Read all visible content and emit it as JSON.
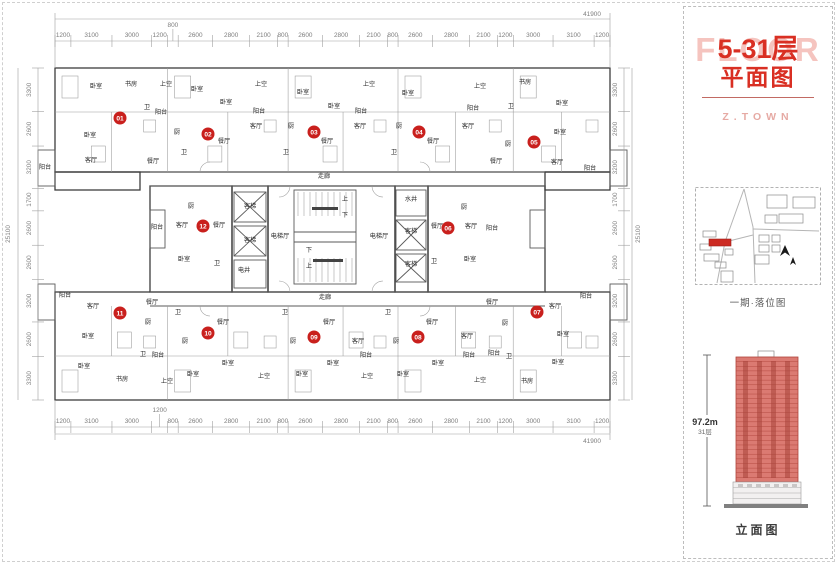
{
  "panel": {
    "watermark": "FLOOR",
    "title_line1": "5-31层",
    "title_line2": "平面图",
    "brand": "Z.TOWN",
    "site_map_caption": "一期·落位图",
    "elevation": {
      "height": "97.2m",
      "floors": "31层",
      "caption": "立面图",
      "floor_count": 31
    }
  },
  "colors": {
    "accent_red": "#d92f23",
    "badge_red": "#c9201d",
    "building_red": "#db7a72",
    "building_line": "#b0453c",
    "watermark_pink": "#f5c4bf",
    "brand_pink": "#e6aaa4"
  },
  "dimensions": {
    "top": {
      "total": "41900",
      "segments": [
        1200,
        3100,
        3000,
        1200,
        800,
        2600,
        2800,
        2100,
        800,
        2600,
        2800,
        2100,
        800,
        2600,
        2800,
        2100,
        1200,
        3000,
        3100,
        1200
      ],
      "raised_index": 4
    },
    "bottom": {
      "total": "41900",
      "segments": [
        1200,
        3100,
        3000,
        1200,
        800,
        2600,
        2800,
        2100,
        800,
        2600,
        2800,
        2100,
        800,
        2600,
        2800,
        2100,
        1200,
        3000,
        3100,
        1200
      ],
      "raised_index": 3
    },
    "left": {
      "total": "25100",
      "segments": [
        3300,
        2600,
        3200,
        1700,
        2600,
        2600,
        3200,
        2600,
        3300
      ]
    },
    "right": {
      "total": "25100",
      "segments": [
        3300,
        2600,
        3200,
        1700,
        2600,
        2600,
        3200,
        2600,
        3300
      ]
    }
  },
  "units": [
    [
      120,
      118,
      "01"
    ],
    [
      208,
      134,
      "02"
    ],
    [
      314,
      132,
      "03"
    ],
    [
      419,
      132,
      "04"
    ],
    [
      534,
      142,
      "05"
    ],
    [
      448,
      228,
      "06"
    ],
    [
      537,
      312,
      "07"
    ],
    [
      418,
      337,
      "08"
    ],
    [
      314,
      337,
      "09"
    ],
    [
      208,
      333,
      "10"
    ],
    [
      120,
      313,
      "11"
    ],
    [
      203,
      226,
      "12"
    ]
  ],
  "room_labels": [
    [
      96,
      88,
      "卧室"
    ],
    [
      131,
      86,
      "书房"
    ],
    [
      166,
      86,
      "上空"
    ],
    [
      197,
      91,
      "卧室"
    ],
    [
      226,
      104,
      "卧室"
    ],
    [
      161,
      114,
      "阳台"
    ],
    [
      147,
      109,
      "卫"
    ],
    [
      90,
      137,
      "卧室"
    ],
    [
      177,
      134,
      "厨"
    ],
    [
      91,
      162,
      "客厅"
    ],
    [
      45,
      169,
      "阳台"
    ],
    [
      153,
      163,
      "餐厅"
    ],
    [
      224,
      143,
      "餐厅"
    ],
    [
      184,
      154,
      "卫"
    ],
    [
      261,
      86,
      "上空"
    ],
    [
      303,
      94,
      "卧室"
    ],
    [
      334,
      108,
      "卧室"
    ],
    [
      259,
      113,
      "阳台"
    ],
    [
      256,
      128,
      "客厅"
    ],
    [
      291,
      128,
      "厨"
    ],
    [
      327,
      143,
      "餐厅"
    ],
    [
      286,
      154,
      "卫"
    ],
    [
      369,
      86,
      "上空"
    ],
    [
      408,
      95,
      "卧室"
    ],
    [
      361,
      113,
      "阳台"
    ],
    [
      360,
      128,
      "客厅"
    ],
    [
      399,
      128,
      "厨"
    ],
    [
      394,
      154,
      "卫"
    ],
    [
      433,
      143,
      "餐厅"
    ],
    [
      480,
      88,
      "上空"
    ],
    [
      525,
      84,
      "书房"
    ],
    [
      562,
      105,
      "卧室"
    ],
    [
      473,
      110,
      "阳台"
    ],
    [
      511,
      108,
      "卫"
    ],
    [
      468,
      128,
      "客厅"
    ],
    [
      508,
      146,
      "厨"
    ],
    [
      496,
      163,
      "餐厅"
    ],
    [
      560,
      134,
      "卧室"
    ],
    [
      557,
      164,
      "客厅"
    ],
    [
      590,
      170,
      "阳台"
    ],
    [
      324,
      178,
      "走廊"
    ],
    [
      325,
      299,
      "走廊"
    ],
    [
      250,
      208,
      "客梯"
    ],
    [
      250,
      242,
      "客梯"
    ],
    [
      244,
      272,
      "电井"
    ],
    [
      280,
      238,
      "电梯厅"
    ],
    [
      379,
      238,
      "电梯厅"
    ],
    [
      411,
      201,
      "水井"
    ],
    [
      411,
      233,
      "客梯"
    ],
    [
      411,
      266,
      "客梯"
    ],
    [
      345,
      201,
      "上"
    ],
    [
      345,
      217,
      "下"
    ],
    [
      309,
      252,
      "下"
    ],
    [
      309,
      268,
      "上"
    ],
    [
      157,
      229,
      "阳台"
    ],
    [
      182,
      227,
      "客厅"
    ],
    [
      191,
      208,
      "厨"
    ],
    [
      219,
      227,
      "餐厅"
    ],
    [
      184,
      261,
      "卧室"
    ],
    [
      217,
      265,
      "卫"
    ],
    [
      437,
      228,
      "餐厅"
    ],
    [
      464,
      209,
      "厨"
    ],
    [
      471,
      228,
      "客厅"
    ],
    [
      492,
      230,
      "阳台"
    ],
    [
      470,
      261,
      "卧室"
    ],
    [
      434,
      263,
      "卫"
    ],
    [
      65,
      297,
      "阳台"
    ],
    [
      93,
      308,
      "客厅"
    ],
    [
      152,
      304,
      "餐厅"
    ],
    [
      88,
      338,
      "卧室"
    ],
    [
      148,
      324,
      "厨"
    ],
    [
      178,
      314,
      "卫"
    ],
    [
      84,
      368,
      "卧室"
    ],
    [
      122,
      381,
      "书房"
    ],
    [
      143,
      356,
      "卫"
    ],
    [
      158,
      357,
      "阳台"
    ],
    [
      167,
      383,
      "上空"
    ],
    [
      185,
      343,
      "厨"
    ],
    [
      223,
      324,
      "餐厅"
    ],
    [
      193,
      376,
      "卧室"
    ],
    [
      228,
      365,
      "卧室"
    ],
    [
      285,
      314,
      "卫"
    ],
    [
      329,
      324,
      "餐厅"
    ],
    [
      293,
      343,
      "厨"
    ],
    [
      358,
      343,
      "客厅"
    ],
    [
      366,
      357,
      "阳台"
    ],
    [
      333,
      365,
      "卧室"
    ],
    [
      264,
      378,
      "上空"
    ],
    [
      302,
      376,
      "卧室"
    ],
    [
      388,
      314,
      "卫"
    ],
    [
      432,
      324,
      "餐厅"
    ],
    [
      396,
      343,
      "厨"
    ],
    [
      438,
      365,
      "卧室"
    ],
    [
      403,
      376,
      "卧室"
    ],
    [
      367,
      378,
      "上空"
    ],
    [
      492,
      304,
      "餐厅"
    ],
    [
      555,
      308,
      "客厅"
    ],
    [
      586,
      298,
      "阳台"
    ],
    [
      505,
      325,
      "厨"
    ],
    [
      467,
      338,
      "客厅"
    ],
    [
      563,
      336,
      "卧室"
    ],
    [
      469,
      357,
      "阳台"
    ],
    [
      494,
      355,
      "阳台"
    ],
    [
      509,
      358,
      "卫"
    ],
    [
      558,
      364,
      "卧室"
    ],
    [
      480,
      382,
      "上空"
    ],
    [
      527,
      383,
      "书房"
    ]
  ]
}
